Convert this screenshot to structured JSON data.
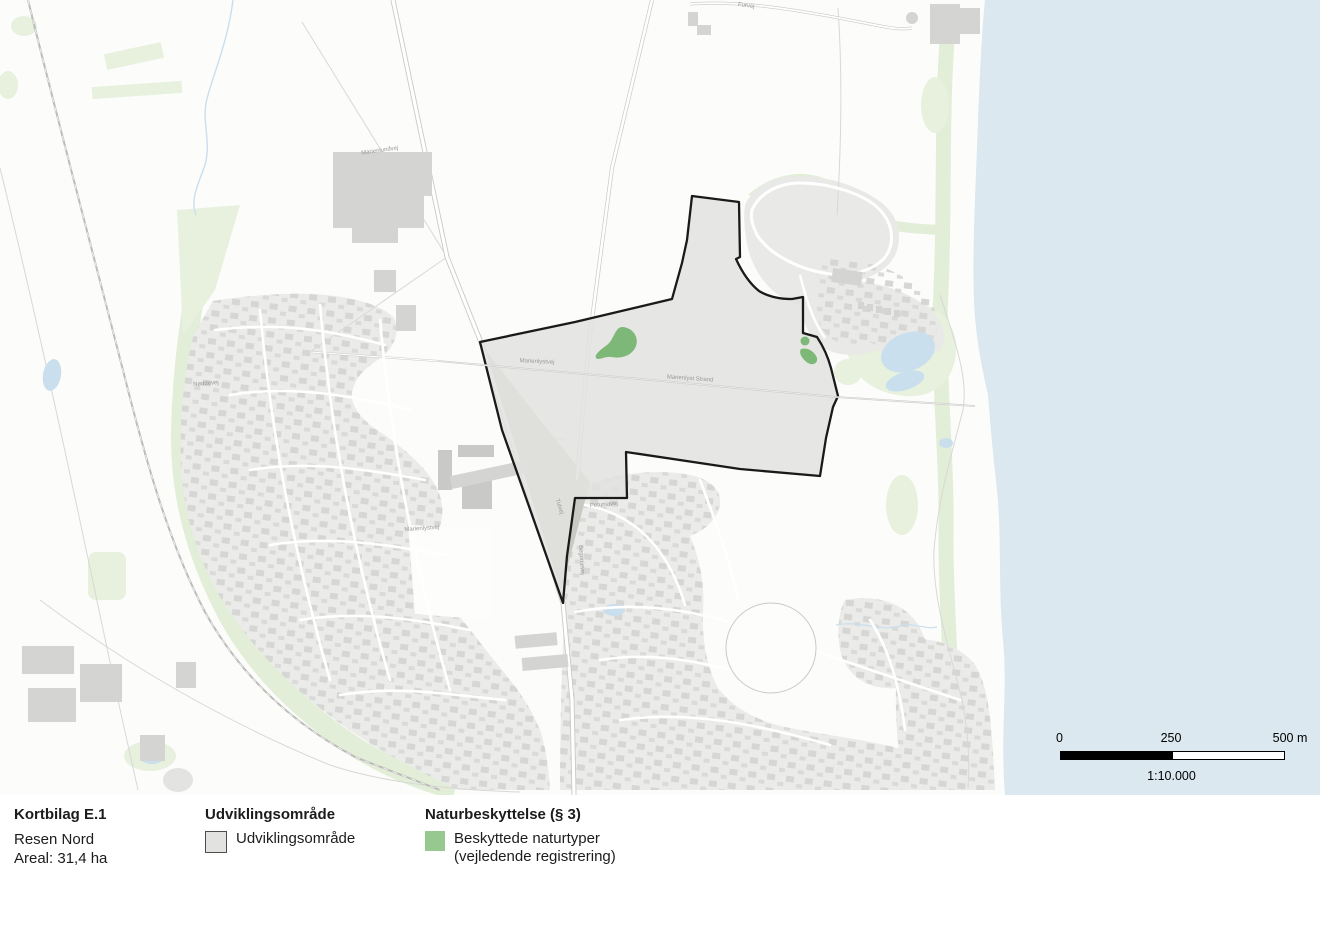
{
  "legend": {
    "doc_title": "Kortbilag E.1",
    "doc_subtitle": "Resen Nord",
    "doc_area": "Areal: 31,4 ha",
    "group_development": {
      "header": "Udviklingsområde",
      "item": "Udviklingsområde"
    },
    "group_nature": {
      "header": "Naturbeskyttelse (§ 3)",
      "item_line1": "Beskyttede naturtyper",
      "item_line2": "(vejledende registrering)"
    }
  },
  "scalebar": {
    "t0": "0",
    "t250": "250",
    "t500": "500 m",
    "ratio": "1:10.000"
  },
  "map": {
    "street_labels": [
      {
        "text": "Furvej",
        "x": 746,
        "y": 7,
        "r": 8
      },
      {
        "text": "Marienlundvej",
        "x": 380,
        "y": 152,
        "r": -8
      },
      {
        "text": "Marienlystvej",
        "x": 537,
        "y": 363,
        "r": 3
      },
      {
        "text": "Marienlyst Strand",
        "x": 690,
        "y": 380,
        "r": 4
      },
      {
        "text": "Marienlystvej",
        "x": 422,
        "y": 530,
        "r": -4
      },
      {
        "text": "Nøddevej",
        "x": 206,
        "y": 385,
        "r": -4
      },
      {
        "text": "Petuniavej",
        "x": 604,
        "y": 506,
        "r": -5
      },
      {
        "text": "Tulvej",
        "x": 558,
        "y": 507,
        "r": 72
      },
      {
        "text": "Begonievej",
        "x": 580,
        "y": 560,
        "r": 86
      }
    ],
    "colors": {
      "land": "#fcfcfb",
      "sea": "#dbe8ef",
      "residential": "#ebebe9",
      "residential_alt": "#e9e9e7",
      "building": "#d4d4d2",
      "green_light": "#e7f1de",
      "green_band": "#e2eed8",
      "nature": "#7db878",
      "nature_legend": "#96c88f",
      "development_fill": "#e2e2e0",
      "development_stroke": "#1a1a1a",
      "water": "#c9dfee",
      "road_casing": "#c9c9c7",
      "street_label": "#9a9a98"
    }
  }
}
